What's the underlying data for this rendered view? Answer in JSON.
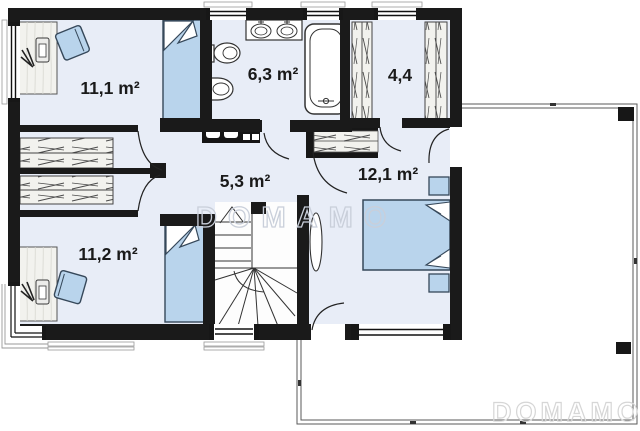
{
  "plan": {
    "watermark_center": "DOMAMO",
    "watermark_corner": "DOMAMO",
    "rooms": [
      {
        "name": "bedroom-top-left",
        "area": "11,1 m²"
      },
      {
        "name": "bathroom",
        "area": "6,3 m²"
      },
      {
        "name": "walkin-closet",
        "area": "4,4"
      },
      {
        "name": "hallway",
        "area": "5,3 m²"
      },
      {
        "name": "bedroom-right",
        "area": "12,1 m²"
      },
      {
        "name": "bedroom-bottom-left",
        "area": "11,2 m²"
      }
    ],
    "colors": {
      "wall": "#1a1a1a",
      "floor": "#e8edf7",
      "furniture_blue": "#b9d4ec",
      "furniture_outline": "#36485a",
      "hatch_fill": "#f2f2ee",
      "watermark_center": "#c9cfda",
      "watermark_corner": "#d6d6d6",
      "terrace_line": "#5a5a5a"
    }
  }
}
